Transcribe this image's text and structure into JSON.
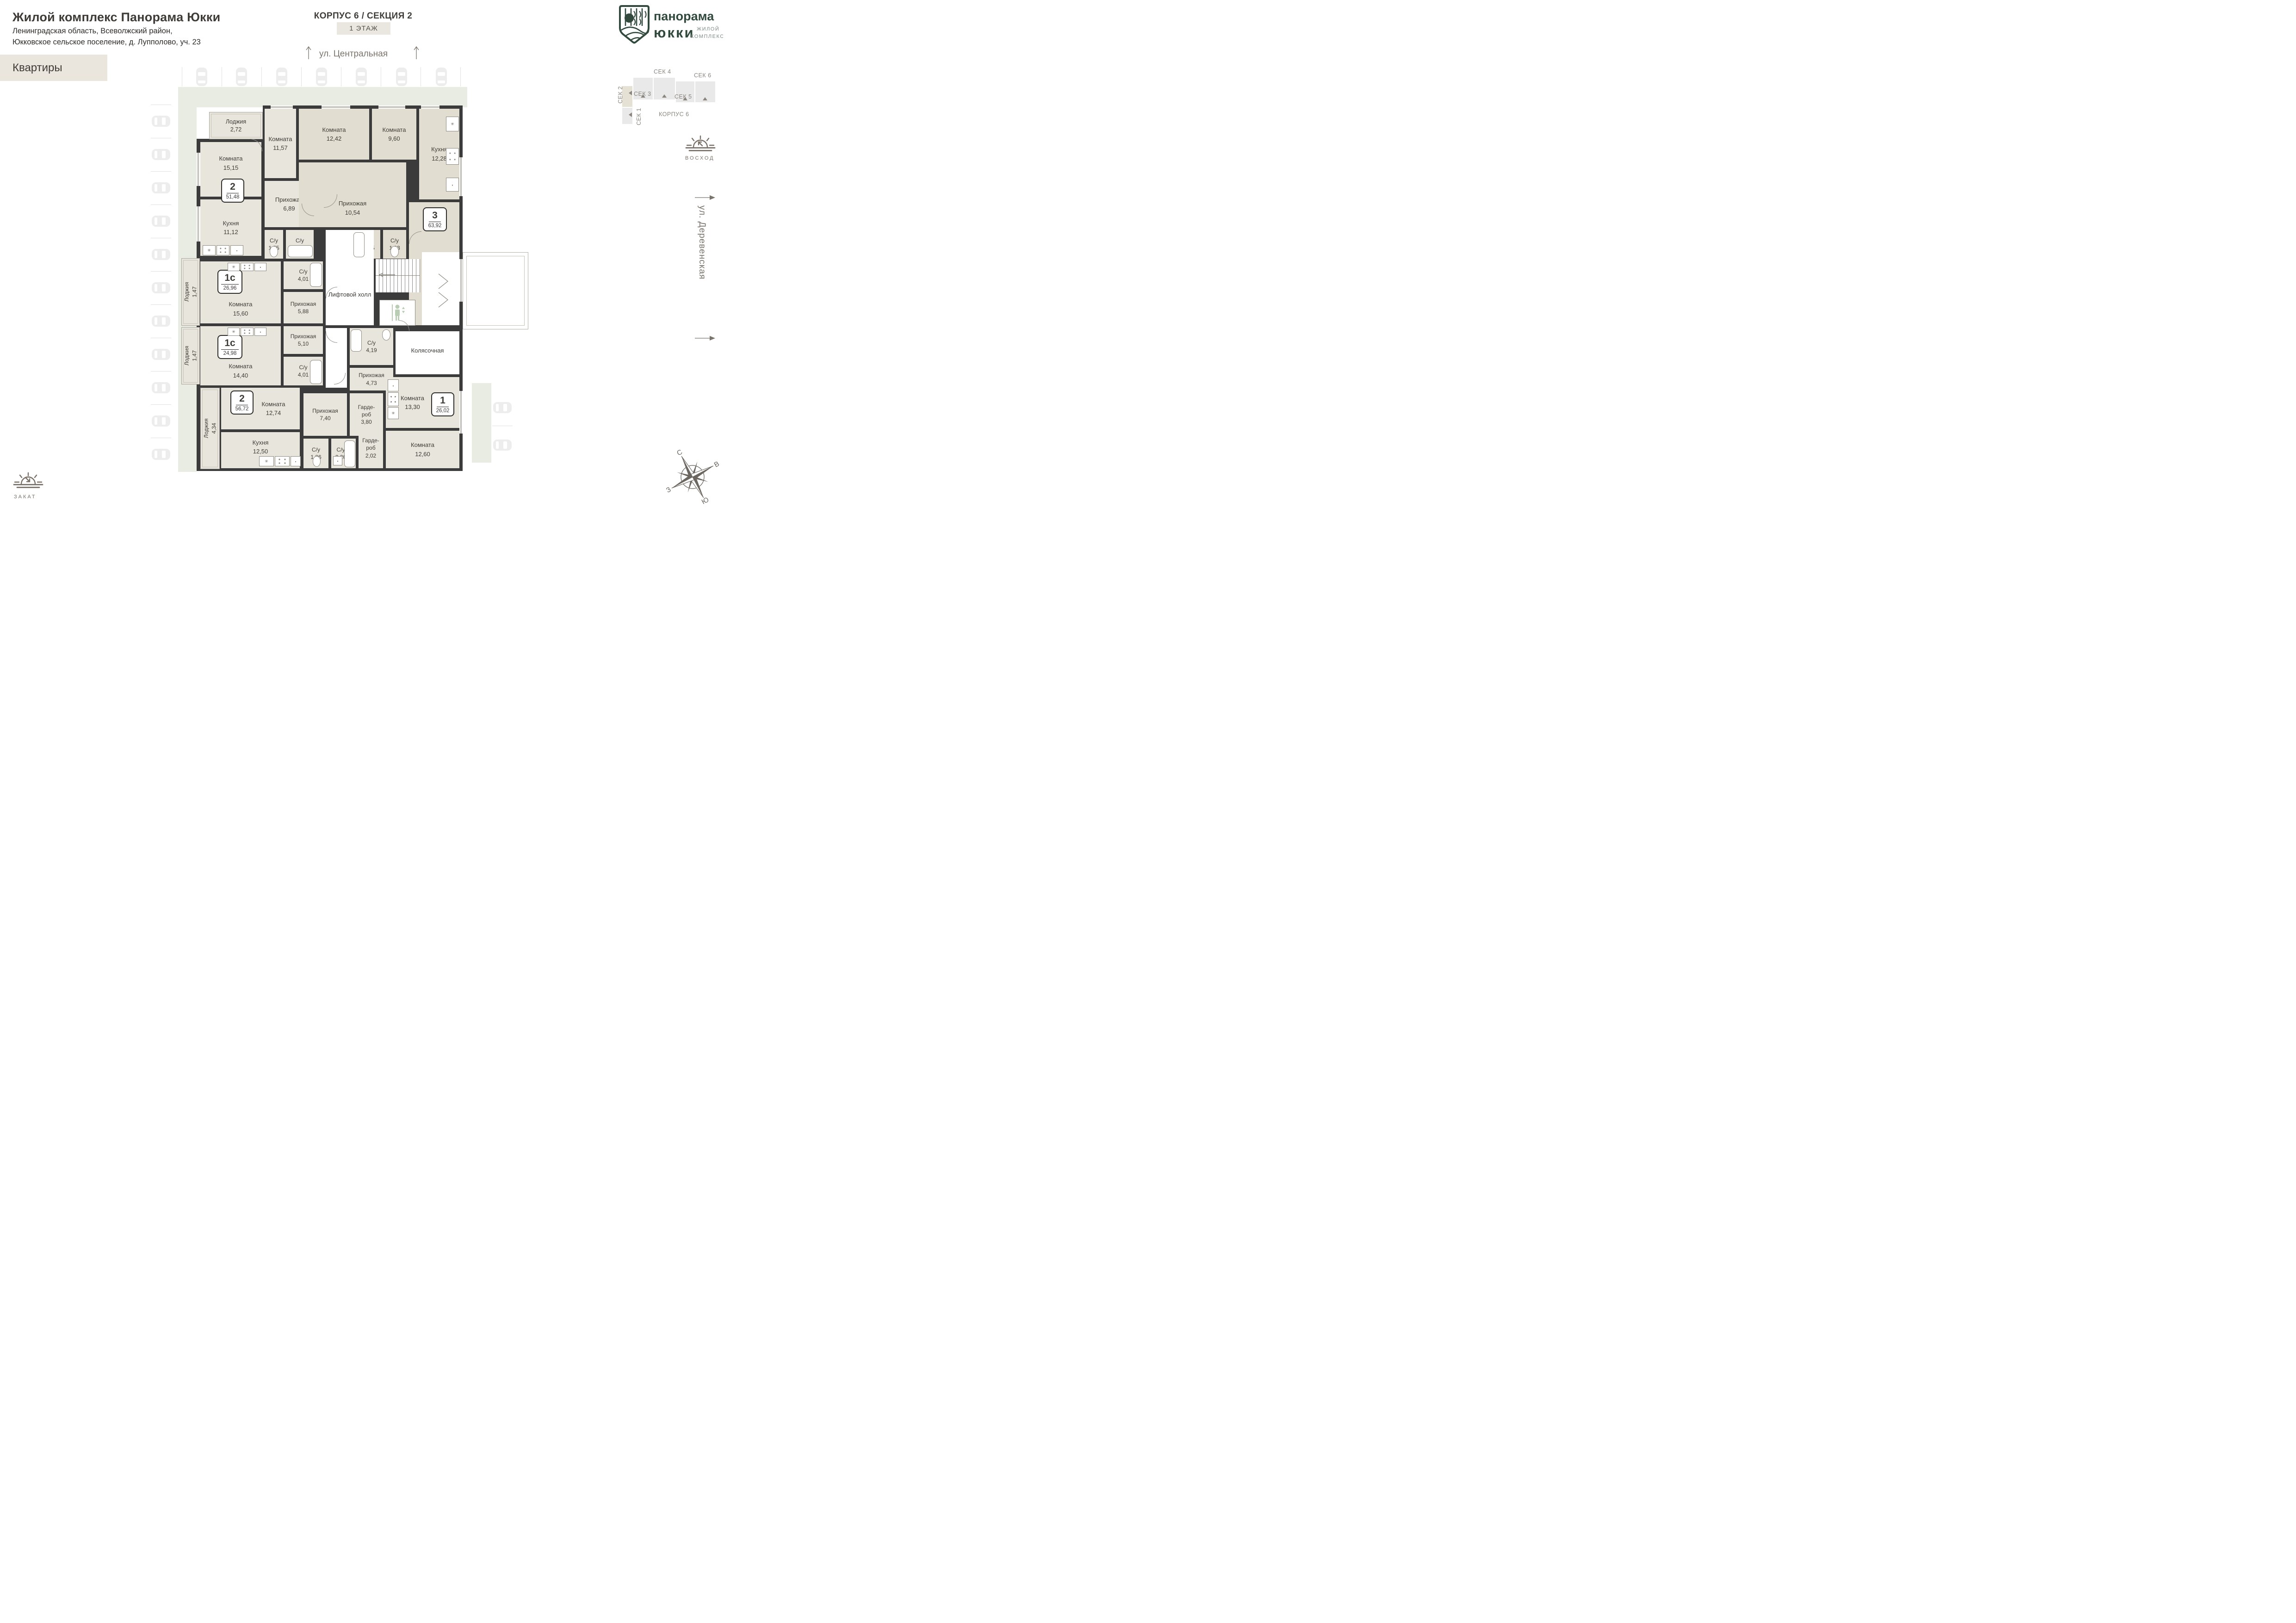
{
  "header": {
    "title": "Жилой комплекс Панорама Юкки",
    "subtitle_line1": "Ленинградская область, Всеволжский район,",
    "subtitle_line2": "Юкковское сельское поселение, д. Лупполово, уч. 23",
    "apartments_tab": "Квартиры"
  },
  "plan_header": {
    "building": "КОРПУС 6 / СЕКЦИЯ 2",
    "floor": "1 ЭТАЖ"
  },
  "streets": {
    "top": "ул. Центральная",
    "right": "ул. Деревенская"
  },
  "logo": {
    "name_line1": "панорама",
    "name_line2": "юкки",
    "type_line1": "ЖИЛОЙ",
    "type_line2": "КОМПЛЕКС"
  },
  "minimap": {
    "korpus": "КОРПУС 6",
    "sections": [
      "СЕК 1",
      "СЕК 2",
      "СЕК 3",
      "СЕК 4",
      "СЕК 5",
      "СЕК 6"
    ],
    "active_section": "СЕК 2"
  },
  "sun": {
    "sunrise": "ВОСХОД",
    "sunset": "ЗАКАТ"
  },
  "compass": {
    "north": "С",
    "east": "В",
    "west": "З",
    "south": "Ю"
  },
  "core": {
    "lift_hall": "Лифтовой холл",
    "stroller_room": "Колясочная"
  },
  "badges": [
    {
      "type": "2",
      "area": "51,48"
    },
    {
      "type": "3",
      "area": "63,92"
    },
    {
      "type": "1с",
      "area": "26,96"
    },
    {
      "type": "1с",
      "area": "24,98"
    },
    {
      "type": "1",
      "area": "26,02"
    },
    {
      "type": "2",
      "area": "56,72"
    }
  ],
  "rooms": [
    {
      "name": "Лоджия",
      "area": "2,72"
    },
    {
      "name": "Комната",
      "area": "15,15"
    },
    {
      "name": "Кухня",
      "area": "11,12"
    },
    {
      "name": "Комната",
      "area": "11,57"
    },
    {
      "name": "Прихожая",
      "area": "6,89"
    },
    {
      "name": "С/у",
      "area": "1,55"
    },
    {
      "name": "С/у",
      "area": "2,48"
    },
    {
      "name": "Комната",
      "area": "12,42"
    },
    {
      "name": "Комната",
      "area": "9,60"
    },
    {
      "name": "Кухня",
      "area": "12,28"
    },
    {
      "name": "Прихожая",
      "area": "10,54"
    },
    {
      "name": "С/у",
      "area": "3,15"
    },
    {
      "name": "С/у",
      "area": "1,93"
    },
    {
      "name": "Комната",
      "area": "14,00"
    },
    {
      "name": "Комната",
      "area": "15,60"
    },
    {
      "name": "С/у",
      "area": "4,01"
    },
    {
      "name": "Прихожая",
      "area": "5,88"
    },
    {
      "name": "Лоджия",
      "area": "1,47"
    },
    {
      "name": "Лоджия",
      "area": "1,47"
    },
    {
      "name": "Комната",
      "area": "14,40"
    },
    {
      "name": "Прихожая",
      "area": "5,10"
    },
    {
      "name": "С/у",
      "area": "4,01"
    },
    {
      "name": "Лифтовой холл",
      "area": ""
    },
    {
      "name": "Колясочная",
      "area": ""
    },
    {
      "name": "С/у",
      "area": "4,19"
    },
    {
      "name": "Прихожая",
      "area": "4,73"
    },
    {
      "name": "Гарде-роб",
      "area": "3,80"
    },
    {
      "name": "Комната",
      "area": "13,30"
    },
    {
      "name": "Комната",
      "area": "12,74"
    },
    {
      "name": "Кухня",
      "area": "12,50"
    },
    {
      "name": "Лоджия",
      "area": "4,34"
    },
    {
      "name": "Прихожая",
      "area": "7,40"
    },
    {
      "name": "С/у",
      "area": "1,86"
    },
    {
      "name": "С/у",
      "area": "3,26"
    },
    {
      "name": "Гарде-роб",
      "area": "2,02"
    },
    {
      "name": "Комната",
      "area": "12,60"
    }
  ],
  "colors": {
    "wall": "#3b3b3b",
    "room": "#e8e5dc",
    "room_alt": "#e1ded1",
    "band": "#e9ece2",
    "accent_tab": "#eae6de",
    "logo_green": "#324a3e",
    "gray_text": "#7a746c",
    "cars": "#ededed"
  }
}
